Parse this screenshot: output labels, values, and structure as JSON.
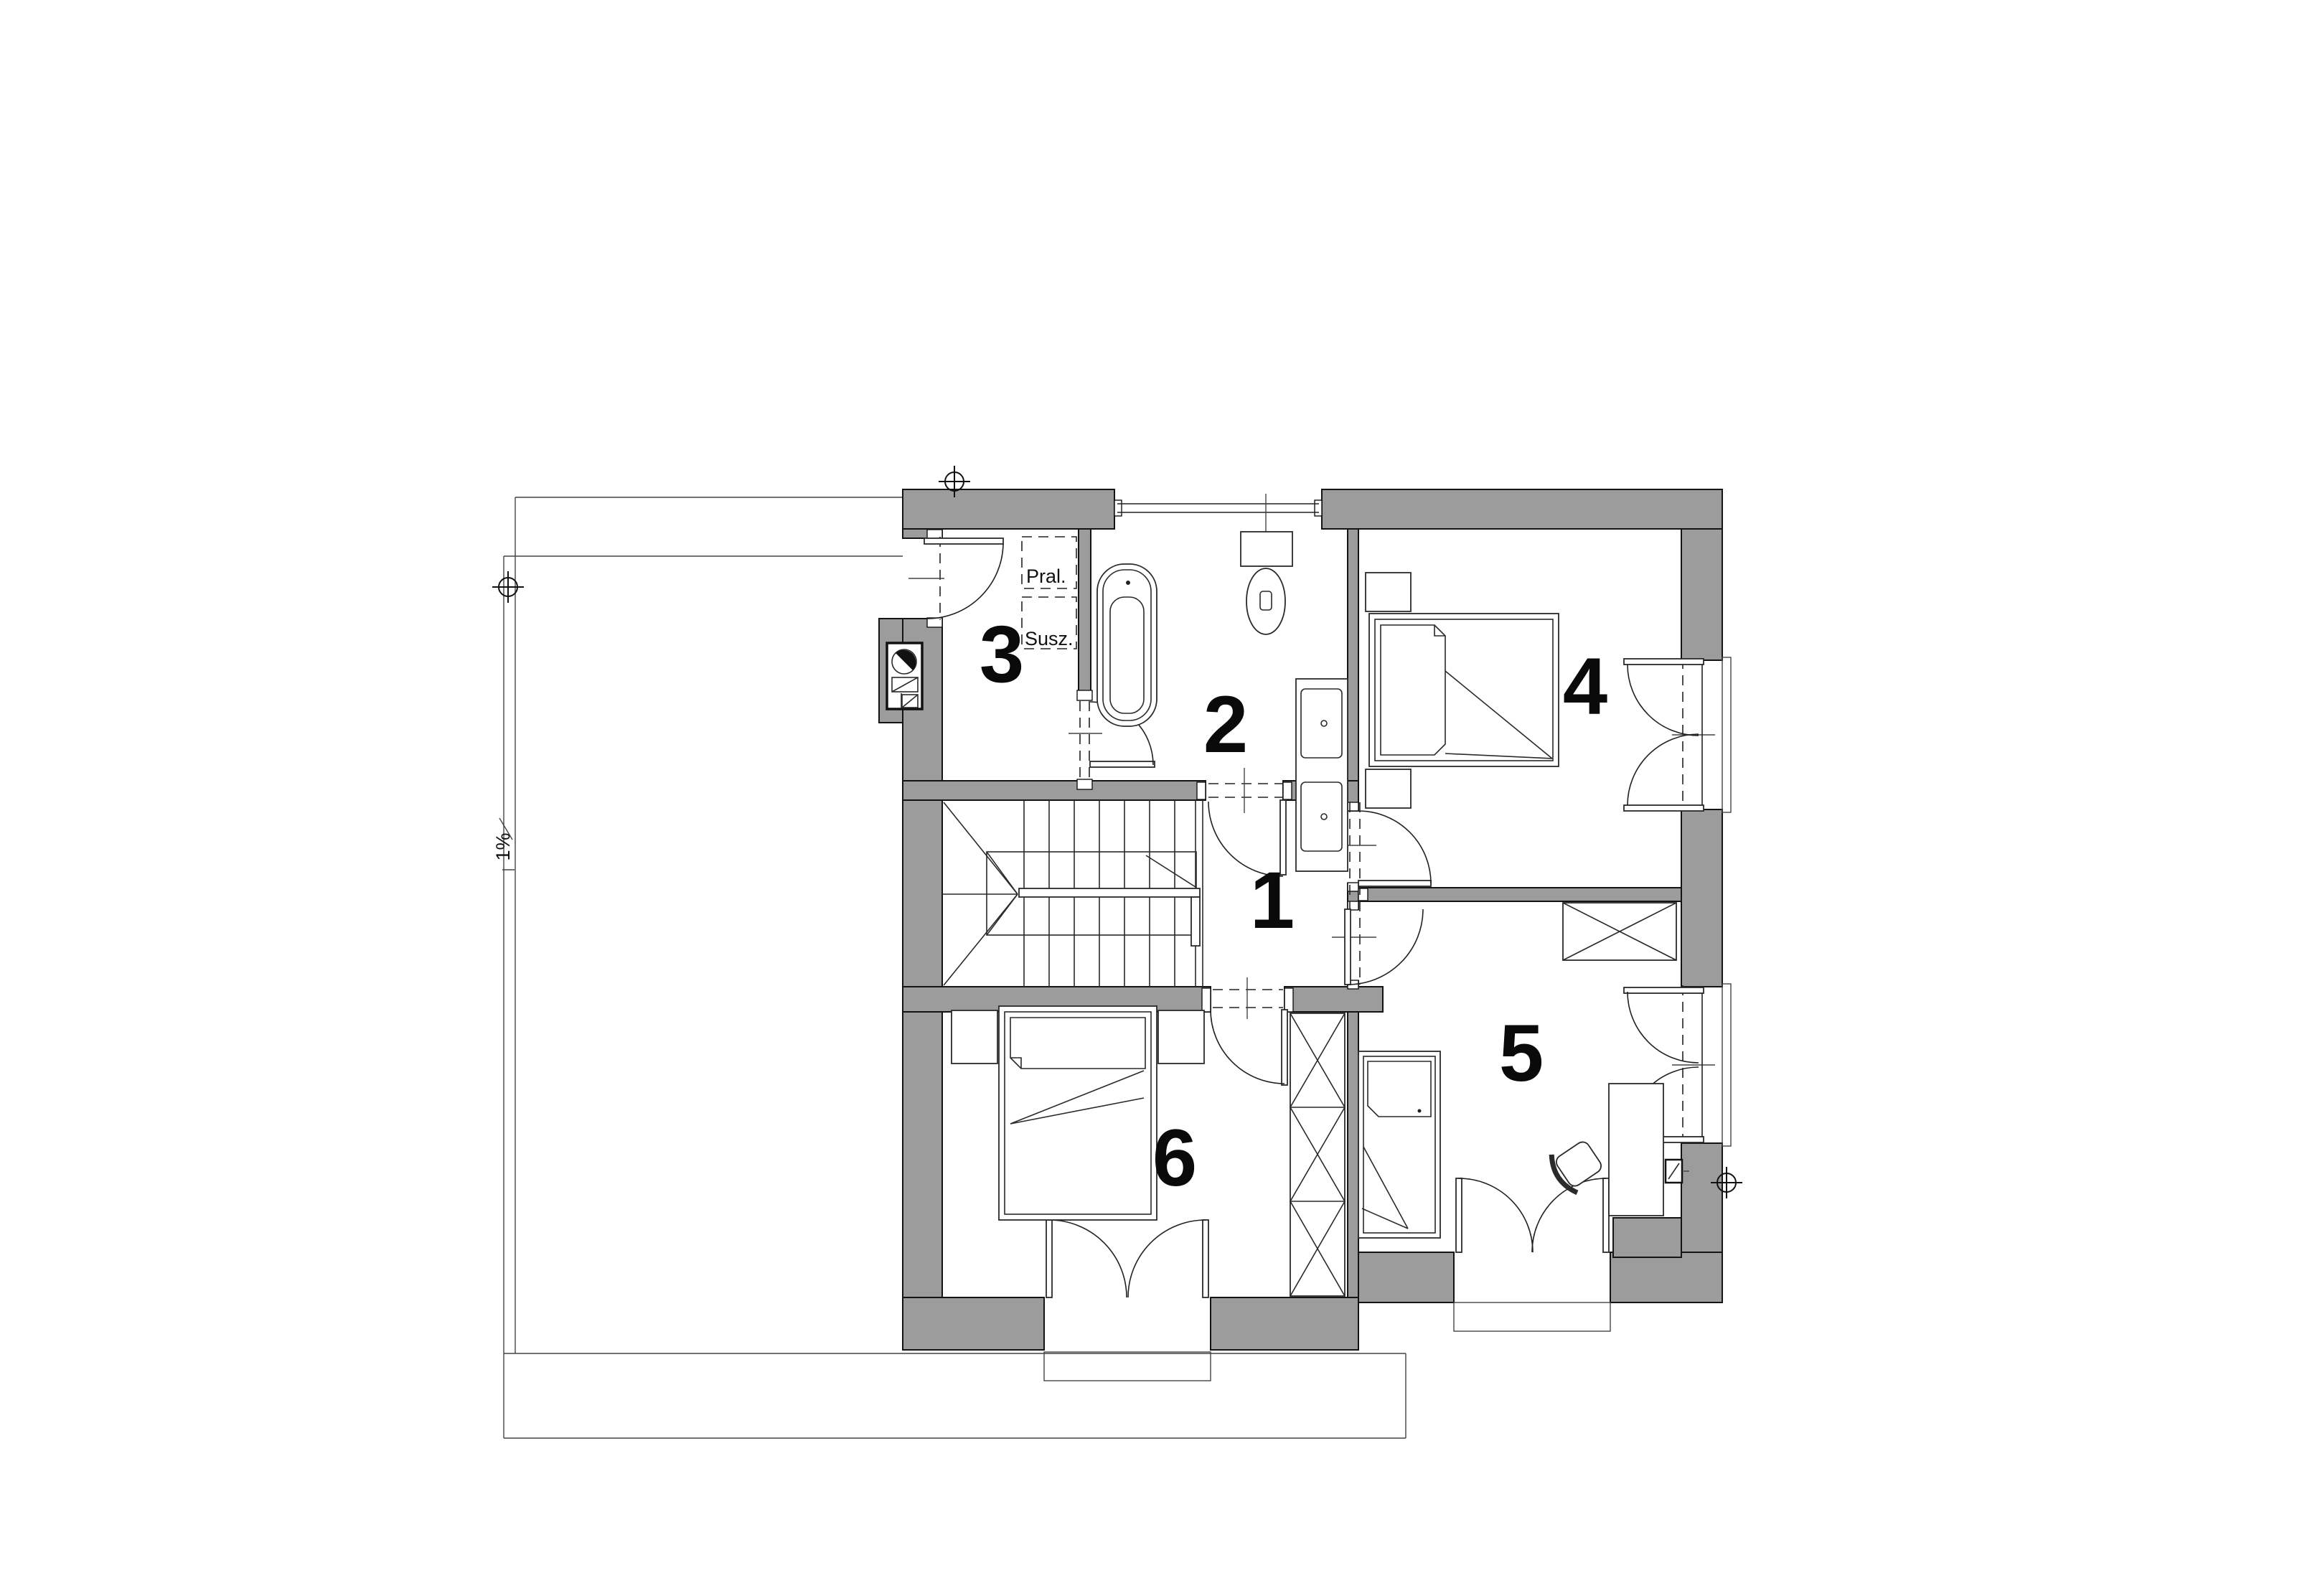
{
  "title": "Floor plan - upper storey",
  "colors": {
    "wall_fill": "#9c9c9c",
    "line": "#141414",
    "background": "#ffffff"
  },
  "rooms": [
    {
      "id": "hall",
      "label": "1"
    },
    {
      "id": "bathroom",
      "label": "2"
    },
    {
      "id": "laundry",
      "label": "3"
    },
    {
      "id": "bedroom-east",
      "label": "4"
    },
    {
      "id": "bedroom-southeast",
      "label": "5"
    },
    {
      "id": "bedroom-southwest",
      "label": "6"
    }
  ],
  "annotations": {
    "washer": "Pral.",
    "dryer": "Susz.",
    "slope": "1%"
  }
}
